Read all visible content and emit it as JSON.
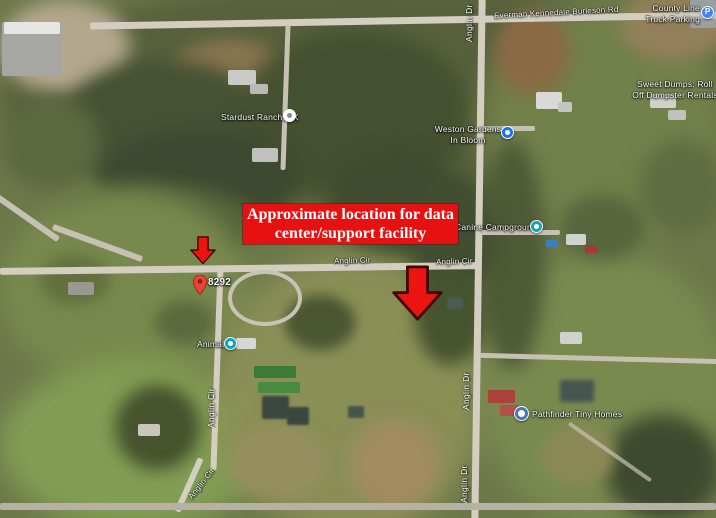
{
  "annotation": {
    "banner_line1": "Approximate location for data",
    "banner_line2": "center/support facility",
    "banner_color": "#e81111",
    "arrow_color": "#ea1510",
    "arrow_outline": "#3d0703"
  },
  "roads": {
    "everman": "Everman Kennedale Burleson Rd",
    "anglin_cir": "Anglin Cir",
    "anglin_dr": "Anglin Dr"
  },
  "places": {
    "county_line": {
      "line1": "County Line",
      "line2": "Truck Parking",
      "icon_letter": "P",
      "icon_color": "#4285f4"
    },
    "sweet_dumps": {
      "line1": "Sweet Dumps: Roll",
      "line2": "Off Dumpster Rentals"
    },
    "stardust_ranch": {
      "name": "Stardust Ranch, TX",
      "icon_color": "#ffffff"
    },
    "weston_gardens": {
      "line1": "Weston Gardens",
      "line2": "In Bloom",
      "icon_color": "#1a73e8"
    },
    "canine_campgrounds": {
      "name": "Canine Campgrounds",
      "icon_color": "#12a5b8"
    },
    "animal": {
      "name": "Animal",
      "icon_color": "#12a5b8"
    },
    "pathfinder": {
      "name": "Pathfinder Tiny Homes",
      "icon_color": "#4479b0"
    },
    "address_pin": {
      "label": "8292",
      "pin_color": "#ea4335"
    }
  }
}
